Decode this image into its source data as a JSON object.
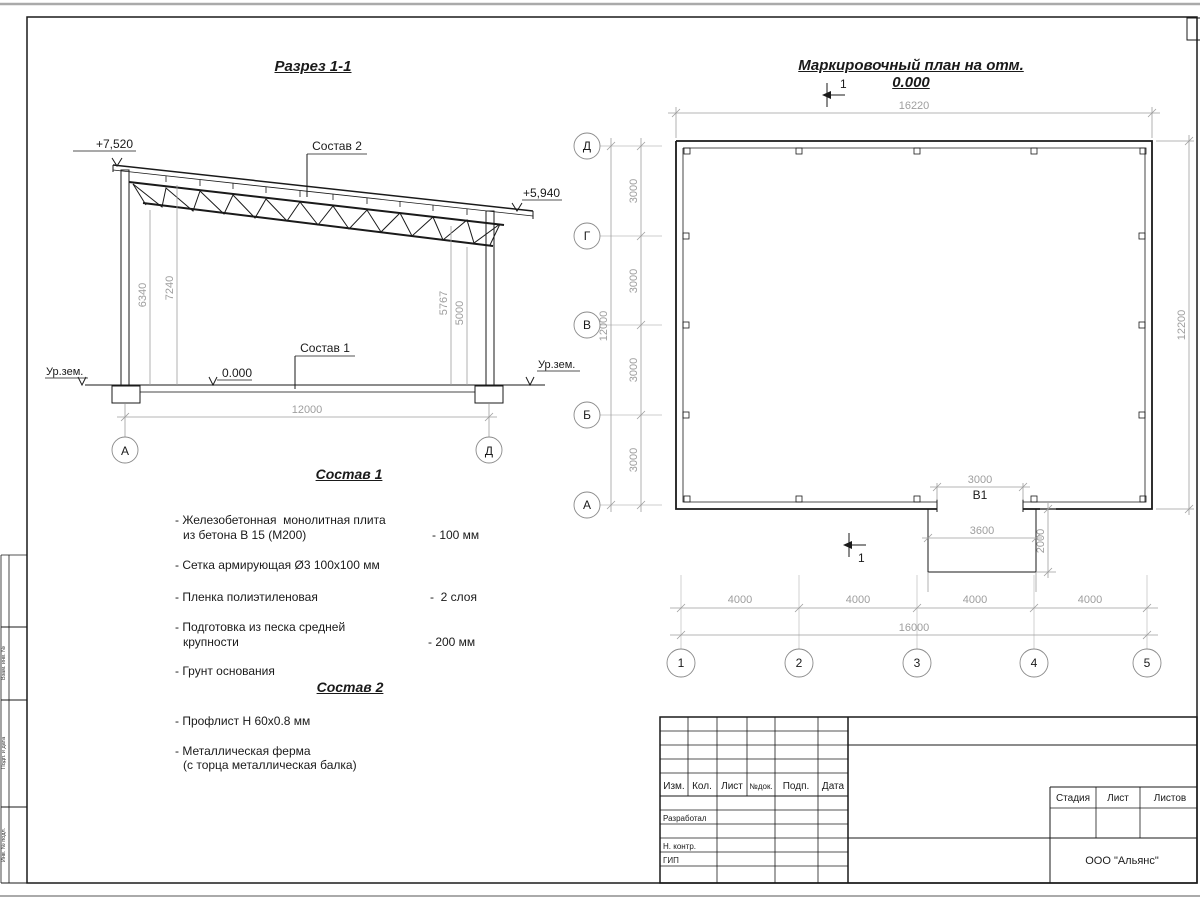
{
  "colors": {
    "line": "#1a1a1a",
    "dim_gray": "#9e9e9e"
  },
  "section": {
    "title": "Разрез 1-1",
    "elev_left": "+7,520",
    "elev_right": "+5,940",
    "elev_zero": "0.000",
    "ground_left": "Ур.зем.",
    "ground_right": "Ур.зем.",
    "callout_roof": "Состав 2",
    "callout_floor": "Состав 1",
    "dim_left_inner": "6340",
    "dim_left_outer": "7240",
    "dim_right_inner": "5767",
    "dim_right_outer": "5000",
    "dim_span": "12000",
    "axis_left": "А",
    "axis_right": "Д"
  },
  "plan": {
    "title": "Маркировочный план на отм. 0.000",
    "dim_top": "16220",
    "dim_right": "12200",
    "dim_left_overall": "12000",
    "dim_left_segments": [
      "3000",
      "3000",
      "3000",
      "3000"
    ],
    "row_axes": [
      "Д",
      "Г",
      "В",
      "Б",
      "А"
    ],
    "col_axes": [
      "1",
      "2",
      "3",
      "4",
      "5"
    ],
    "dim_bottom_segments": [
      "4000",
      "4000",
      "4000",
      "4000"
    ],
    "dim_bottom_overall": "16000",
    "opening_label": "В1",
    "dim_opening": "3000",
    "dim_porch_width": "3600",
    "dim_porch_depth": "2000",
    "section_mark": "1"
  },
  "sostav1": {
    "title": "Состав 1",
    "items": [
      {
        "text": "- Железобетонная  монолитная плита",
        "text2": "из бетона В 15 (М200)",
        "value": "- 100 мм"
      },
      {
        "text": "- Сетка армирующая Ø3 100х100 мм"
      },
      {
        "text": "- Пленка полиэтиленовая",
        "value": "-  2 слоя"
      },
      {
        "text": "- Подготовка из песка средней",
        "text2": "крупности",
        "value": "- 200 мм"
      },
      {
        "text": "- Грунт основания"
      }
    ]
  },
  "sostav2": {
    "title": "Состав 2",
    "items": [
      {
        "text": "- Профлист Н 60х0.8 мм"
      },
      {
        "text": "- Металлическая ферма",
        "text2": "(с торца металлическая балка)"
      }
    ]
  },
  "titleblock": {
    "header_cols": [
      "Изм.",
      "Кол.",
      "Лист",
      "№док.",
      "Подп.",
      "Дата"
    ],
    "sign_rows": [
      "Разработал",
      "Н. контр.",
      "ГИП"
    ],
    "stage_cols": [
      "Стадия",
      "Лист",
      "Листов"
    ],
    "company": "ООО \"Альянс\""
  },
  "margin_labels": [
    "Взам. инв. №",
    "Подп. и дата",
    "Инв. № подл."
  ]
}
